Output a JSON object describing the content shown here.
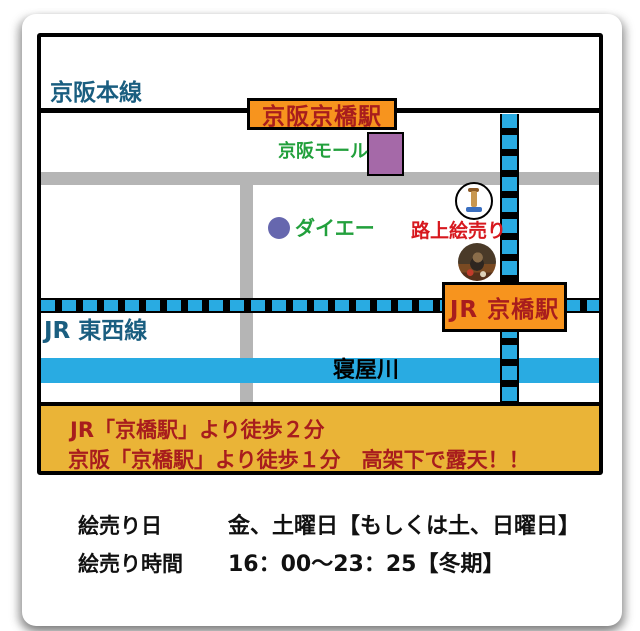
{
  "map": {
    "keihan_main_line": "京阪本線",
    "keihan_station": "京阪京橋駅",
    "keihan_mall": "京阪モール",
    "daiei": "ダイエー",
    "street_art": "路上絵売り",
    "jr_station": "JR 京橋駅",
    "jr_tozai_line": "JR 東西線",
    "river": "寝屋川",
    "icons": {
      "artist_figure": "artist-figure-icon",
      "street_photo": "street-photo-thumbnail"
    }
  },
  "banner": {
    "line1": "JR「京橋駅」より徒歩２分",
    "line2": "京阪「京橋駅」より徒歩１分　高架下で露天！！"
  },
  "info": {
    "rows": [
      {
        "label": "絵売り日",
        "value": "金、土曜日【もしくは土、日曜日】"
      },
      {
        "label": "絵売り時間",
        "value": "16：00～23：25【冬期】"
      }
    ]
  },
  "colors": {
    "rail_blue": "#29ABE2",
    "river_blue": "#29ABE2",
    "road_gray": "#B5B5B5",
    "station_orange": "#F7941E",
    "banner_yellow": "#EAB437",
    "station_text_red": "#A81D1D",
    "street_art_red": "#D7181E",
    "landmark_green": "#22A03C",
    "line_label_teal": "#1A5E80",
    "mall_purple": "#A569A8",
    "daiei_purple": "#6667AE"
  }
}
